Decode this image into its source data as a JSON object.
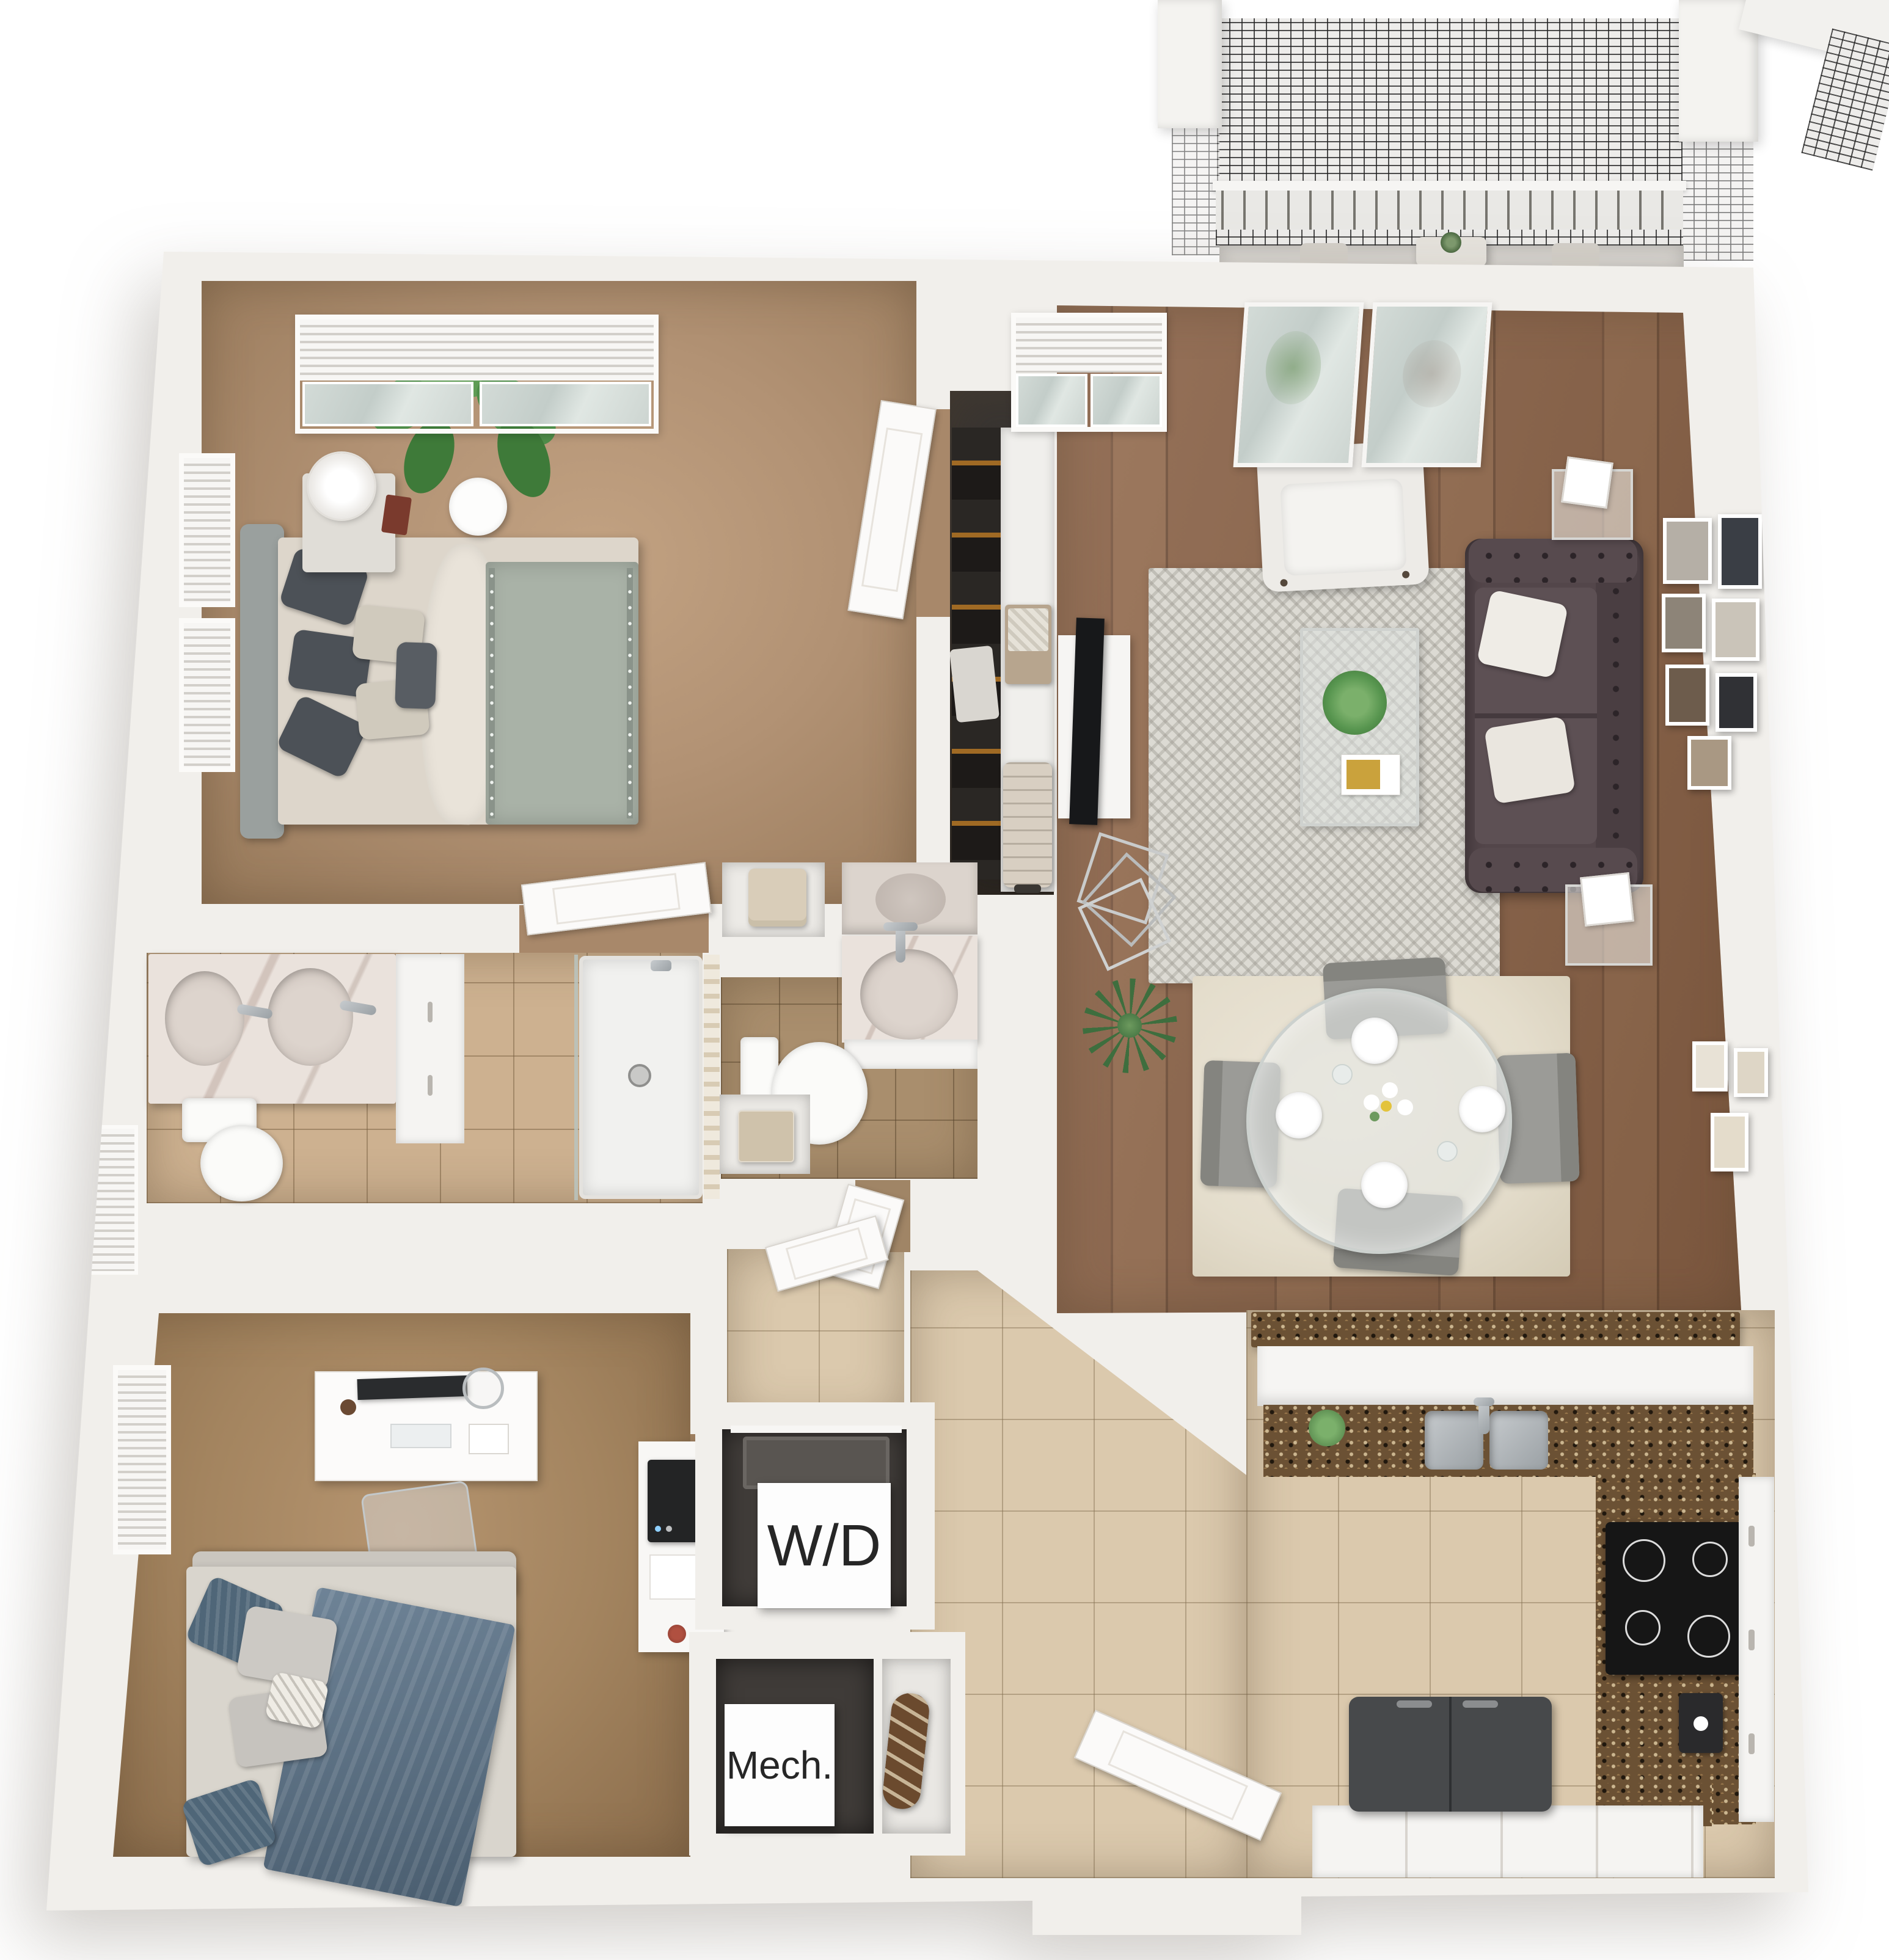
{
  "labels": {
    "washer_dryer": "W/D",
    "mechanical": "Mech."
  },
  "palette": {
    "background": "#ffffff",
    "wall": "#f1efeb",
    "wall_shadow": "#d9d5cf",
    "carpet_bedroom1": "#b29274",
    "carpet_bedroom2": "#a3845f",
    "wood_floor": "#8a6247",
    "tile_entry": "#dbc9ad",
    "tile_bath1": "#cdb190",
    "tile_bath2": "#a98e6d",
    "sofa_brown": "#53464a",
    "bed1_blanket_sage": "#a9b2a7",
    "bed2_denim_blue": "#5a7288",
    "granite_counter": "#6b5134",
    "marble_vanity": "#eae2dc",
    "mesh_screen": "#3a3a3a",
    "plant_green": "#57954f",
    "rug_living_gray": "#dcdad3",
    "rug_dining": "#e8e2d4",
    "label_text": "#262626"
  }
}
